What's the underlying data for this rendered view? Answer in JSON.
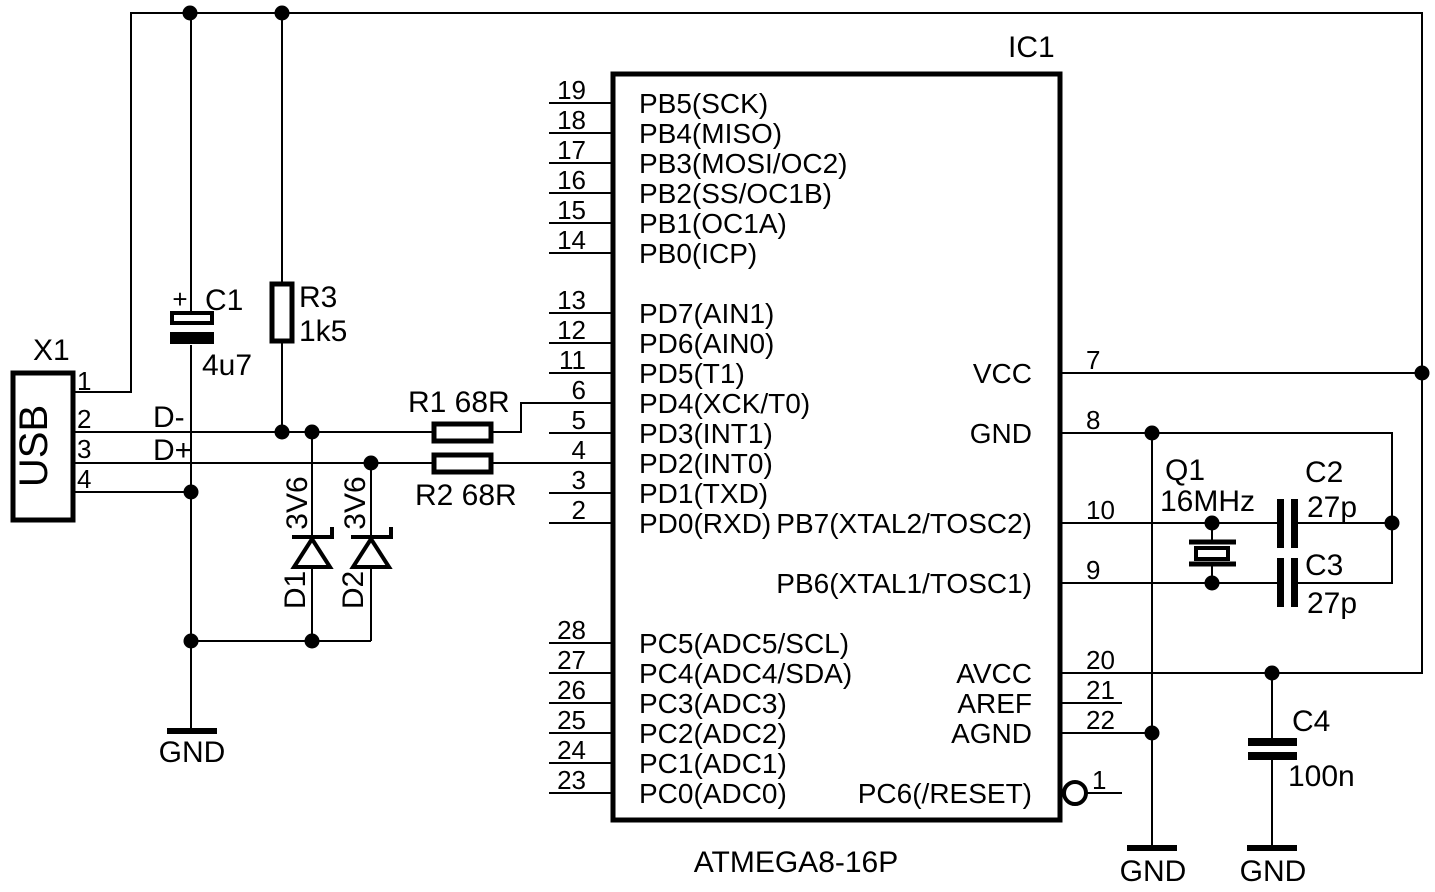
{
  "ic": {
    "ref": "IC1",
    "part": "ATMEGA8-16P",
    "left_pins": [
      {
        "num": "19",
        "label": "PB5(SCK)"
      },
      {
        "num": "18",
        "label": "PB4(MISO)"
      },
      {
        "num": "17",
        "label": "PB3(MOSI/OC2)"
      },
      {
        "num": "16",
        "label": "PB2(SS/OC1B)"
      },
      {
        "num": "15",
        "label": "PB1(OC1A)"
      },
      {
        "num": "14",
        "label": "PB0(ICP)"
      },
      {
        "num": "13",
        "label": "PD7(AIN1)"
      },
      {
        "num": "12",
        "label": "PD6(AIN0)"
      },
      {
        "num": "11",
        "label": "PD5(T1)"
      },
      {
        "num": "6",
        "label": "PD4(XCK/T0)"
      },
      {
        "num": "5",
        "label": "PD3(INT1)"
      },
      {
        "num": "4",
        "label": "PD2(INT0)"
      },
      {
        "num": "3",
        "label": "PD1(TXD)"
      },
      {
        "num": "2",
        "label": "PD0(RXD)"
      },
      {
        "num": "28",
        "label": "PC5(ADC5/SCL)"
      },
      {
        "num": "27",
        "label": "PC4(ADC4/SDA)"
      },
      {
        "num": "26",
        "label": "PC3(ADC3)"
      },
      {
        "num": "25",
        "label": "PC2(ADC2)"
      },
      {
        "num": "24",
        "label": "PC1(ADC1)"
      },
      {
        "num": "23",
        "label": "PC0(ADC0)"
      }
    ],
    "right_pins": [
      {
        "num": "7",
        "label": "VCC"
      },
      {
        "num": "8",
        "label": "GND"
      },
      {
        "num": "10",
        "label": "PB7(XTAL2/TOSC2)"
      },
      {
        "num": "9",
        "label": "PB6(XTAL1/TOSC1)"
      },
      {
        "num": "20",
        "label": "AVCC"
      },
      {
        "num": "21",
        "label": "AREF"
      },
      {
        "num": "22",
        "label": "AGND"
      },
      {
        "num": "1",
        "label": "PC6(/RESET)"
      }
    ]
  },
  "usb": {
    "ref": "X1",
    "label": "USB",
    "pin_numbers": [
      "1",
      "2",
      "3",
      "4"
    ],
    "d_minus": "D-",
    "d_plus": "D+"
  },
  "components": {
    "c1": {
      "ref": "C1",
      "value": "4u7",
      "plus": "+"
    },
    "r3": {
      "ref": "R3",
      "value": "1k5"
    },
    "r1": {
      "label": "R1 68R"
    },
    "r2": {
      "label": "R2 68R"
    },
    "d1": {
      "ref": "D1",
      "value": "3V6"
    },
    "d2": {
      "ref": "D2",
      "value": "3V6"
    },
    "q1": {
      "ref": "Q1",
      "value": "16MHz"
    },
    "c2": {
      "ref": "C2",
      "value": "27p"
    },
    "c3": {
      "ref": "C3",
      "value": "27p"
    },
    "c4": {
      "ref": "C4",
      "value": "100n"
    }
  },
  "grounds": {
    "left": "GND",
    "middle": "GND",
    "right": "GND"
  },
  "colors": {
    "ink": "#000000",
    "background": "#ffffff"
  }
}
